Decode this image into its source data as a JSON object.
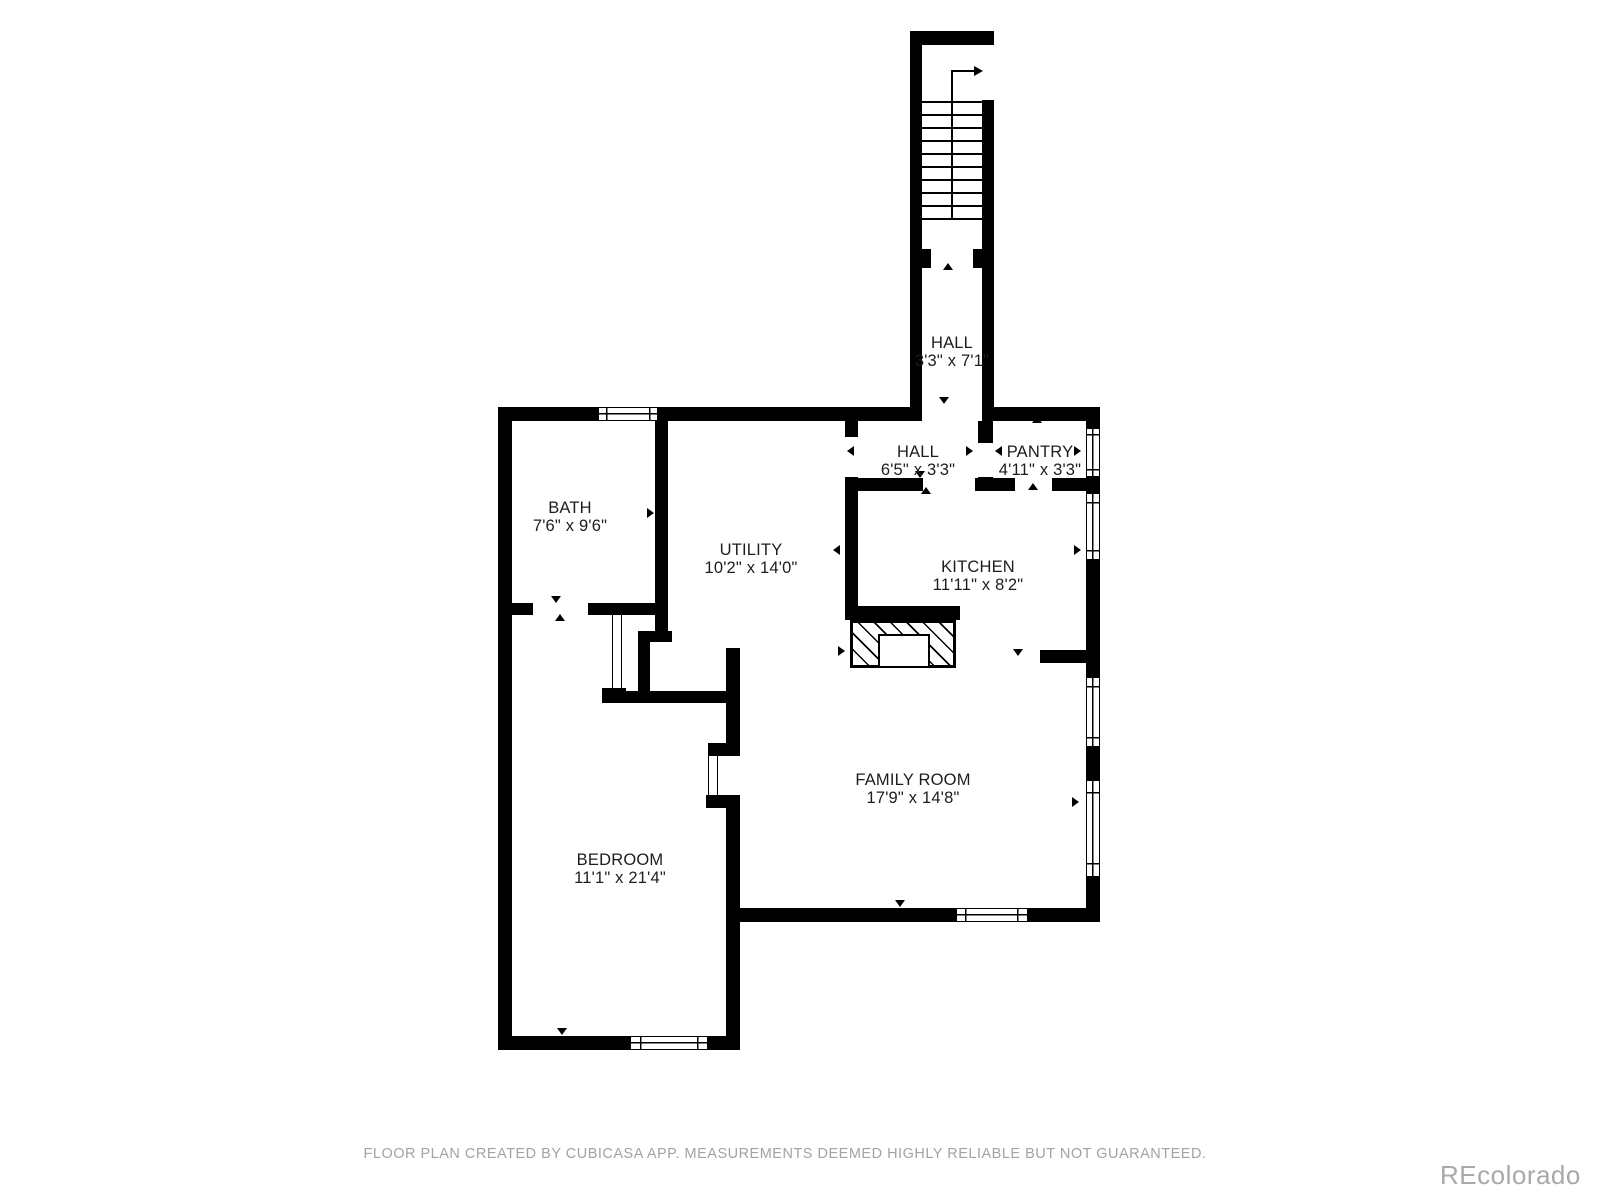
{
  "floorplan": {
    "rooms": [
      {
        "name": "HALL",
        "dims": "3'3\" x 7'1\"",
        "cx": 952,
        "cy": 352
      },
      {
        "name": "HALL",
        "dims": "6'5\" x 3'3\"",
        "cx": 918,
        "cy": 461
      },
      {
        "name": "PANTRY",
        "dims": "4'11\" x 3'3\"",
        "cx": 1040,
        "cy": 461
      },
      {
        "name": "BATH",
        "dims": "7'6\" x 9'6\"",
        "cx": 570,
        "cy": 517
      },
      {
        "name": "UTILITY",
        "dims": "10'2\" x 14'0\"",
        "cx": 751,
        "cy": 559
      },
      {
        "name": "KITCHEN",
        "dims": "11'11\" x 8'2\"",
        "cx": 978,
        "cy": 576
      },
      {
        "name": "FAMILY ROOM",
        "dims": "17'9\" x 14'8\"",
        "cx": 913,
        "cy": 789
      },
      {
        "name": "BEDROOM",
        "dims": "11'1\" x 21'4\"",
        "cx": 620,
        "cy": 869
      }
    ],
    "footer": "FLOOR PLAN CREATED BY CUBICASA APP. MEASUREMENTS DEEMED HIGHLY RELIABLE BUT NOT GUARANTEED.",
    "watermark": "REcolorado",
    "colors": {
      "wall": "#000000",
      "label": "#1d1d1d",
      "footer": "#a3a3a3",
      "watermark": "#a9a9a9"
    },
    "geometry": {
      "walls": [
        [
          910,
          31,
          84,
          14
        ],
        [
          910,
          31,
          12,
          390
        ],
        [
          982,
          100,
          12,
          321
        ],
        [
          922,
          249,
          9,
          19
        ],
        [
          973,
          249,
          9,
          19
        ],
        [
          498,
          407,
          100,
          14
        ],
        [
          658,
          407,
          264,
          14
        ],
        [
          982,
          407,
          118,
          14
        ],
        [
          498,
          407,
          14,
          643
        ],
        [
          498,
          1036,
          132,
          14
        ],
        [
          708,
          1036,
          32,
          14
        ],
        [
          726,
          908,
          230,
          14
        ],
        [
          1028,
          908,
          72,
          14
        ],
        [
          1086,
          407,
          14,
          21
        ],
        [
          1086,
          477,
          14,
          16
        ],
        [
          1086,
          560,
          14,
          117
        ],
        [
          1086,
          747,
          14,
          33
        ],
        [
          1086,
          877,
          14,
          45
        ],
        [
          498,
          603,
          35,
          12
        ],
        [
          588,
          603,
          69,
          12
        ],
        [
          655,
          407,
          13,
          233
        ],
        [
          638,
          631,
          34,
          11
        ],
        [
          638,
          631,
          12,
          70
        ],
        [
          610,
          691,
          120,
          12
        ],
        [
          602,
          688,
          24,
          15
        ],
        [
          845,
          421,
          13,
          16
        ],
        [
          845,
          477,
          13,
          138
        ],
        [
          978,
          421,
          15,
          22
        ],
        [
          978,
          477,
          15,
          14
        ],
        [
          845,
          478,
          78,
          13
        ],
        [
          975,
          478,
          40,
          13
        ],
        [
          1052,
          478,
          48,
          13
        ],
        [
          845,
          606,
          115,
          14
        ],
        [
          1040,
          650,
          46,
          13
        ],
        [
          726,
          648,
          14,
          95
        ],
        [
          708,
          743,
          32,
          13
        ],
        [
          706,
          795,
          34,
          13
        ],
        [
          726,
          795,
          14,
          255
        ]
      ],
      "windows": [
        [
          598,
          407,
          60,
          14,
          "h"
        ],
        [
          630,
          1036,
          78,
          14,
          "h"
        ],
        [
          956,
          908,
          72,
          14,
          "h"
        ],
        [
          1086,
          428,
          14,
          49,
          "v"
        ],
        [
          1086,
          493,
          14,
          67,
          "v"
        ],
        [
          1086,
          677,
          14,
          70,
          "v"
        ],
        [
          1086,
          780,
          14,
          97,
          "v"
        ]
      ],
      "door_leaves": [
        [
          612,
          615,
          10,
          73
        ],
        [
          708,
          756,
          10,
          39
        ]
      ],
      "markers": [
        [
          948,
          267,
          "up"
        ],
        [
          944,
          401,
          "down"
        ],
        [
          852,
          450,
          "left"
        ],
        [
          971,
          450,
          "right"
        ],
        [
          1000,
          450,
          "left"
        ],
        [
          920,
          475,
          "down"
        ],
        [
          926,
          491,
          "up"
        ],
        [
          1033,
          487,
          "up"
        ],
        [
          1037,
          420,
          "up"
        ],
        [
          556,
          418,
          "up"
        ],
        [
          699,
          418,
          "up"
        ],
        [
          506,
          516,
          "left"
        ],
        [
          652,
          512,
          "right"
        ],
        [
          556,
          600,
          "down"
        ],
        [
          560,
          618,
          "up"
        ],
        [
          838,
          549,
          "left"
        ],
        [
          843,
          650,
          "right"
        ],
        [
          648,
          646,
          "left"
        ],
        [
          697,
          695,
          "down"
        ],
        [
          507,
          696,
          "right"
        ],
        [
          562,
          1032,
          "down"
        ],
        [
          900,
          904,
          "down"
        ],
        [
          1079,
          450,
          "right"
        ],
        [
          1079,
          549,
          "right"
        ],
        [
          1077,
          801,
          "right"
        ],
        [
          1018,
          653,
          "down"
        ],
        [
          905,
          612,
          "down"
        ]
      ],
      "stairs": {
        "x": 922,
        "width": 60,
        "tread_y0": 101,
        "tread_step": 13,
        "tread_count": 10,
        "rail_x": 951,
        "rail_y1": 70,
        "rail_y2": 218,
        "arrow": {
          "x1": 952,
          "y": 70,
          "x2": 974,
          "tip": 974
        }
      },
      "fireplace": {
        "x": 850,
        "y": 620,
        "w": 106,
        "h": 48,
        "inner": {
          "x": 878,
          "y": 634,
          "w": 52,
          "h": 34
        }
      }
    }
  }
}
